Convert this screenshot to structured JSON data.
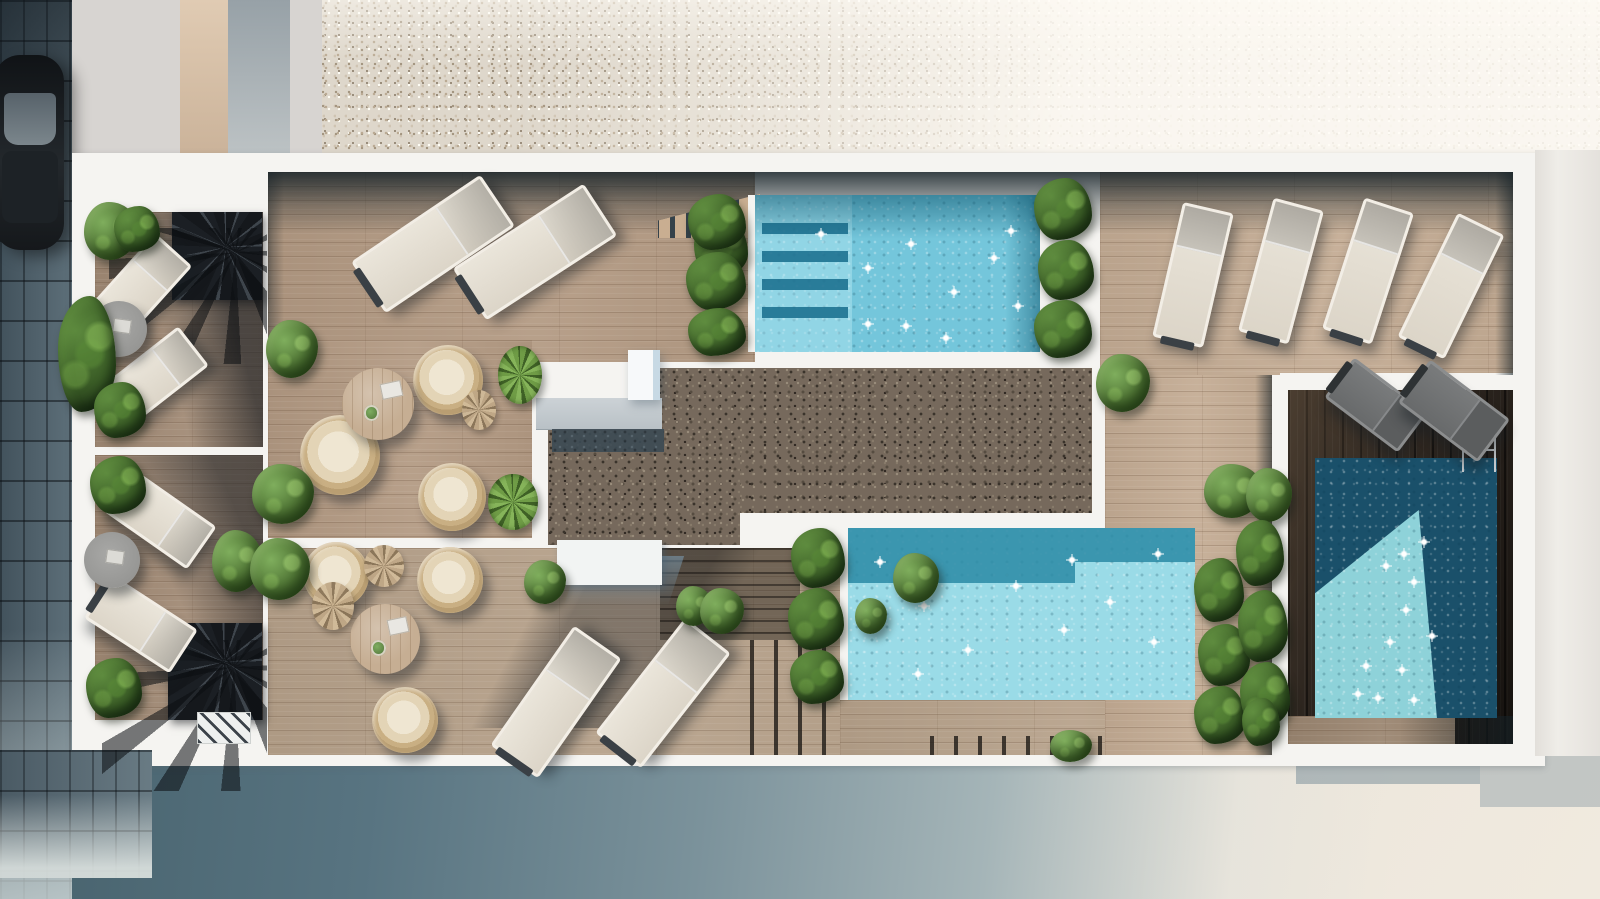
{
  "colors": {
    "white_paint": "#f5f4f1",
    "facade": "#ecebe6",
    "plaza_light": "#e9e2d7",
    "plaza_shadow": "#4a6675",
    "pavement": "#4d5c66",
    "car_body": "#17191c",
    "wood_a": "#b39a83",
    "wood_b": "#b7a28b",
    "wood_c": "#c4ac94",
    "wood_balcony": "#a18a75",
    "wood_tan": "#9b8671",
    "gravel_beige": "#ded7cb",
    "gravel_dark": "#76695c",
    "terrace_dark": "#2b241e",
    "water_pool1": "#74c6db",
    "water_pool2": "#9adbe7",
    "water_pool3_deep": "#1a506a",
    "water_pool3_lit": "#8ed2d9",
    "water_shadow_band": "#2a89a4",
    "concrete_slab": "#c6ccd1",
    "table_wood": "#c6ae93",
    "sparkle": "#ffffff"
  },
  "scene": {
    "loungers": [
      {
        "n": "sun-lounger",
        "v": "cream",
        "x": 355,
        "y": 213,
        "w": 150,
        "h": 56,
        "r": -34
      },
      {
        "n": "sun-lounger",
        "v": "cream",
        "x": 457,
        "y": 221,
        "w": 150,
        "h": 56,
        "r": -33
      },
      {
        "n": "sun-lounger",
        "v": "p",
        "x": 1167,
        "y": 206,
        "w": 46,
        "h": 132,
        "r": 13
      },
      {
        "n": "sun-lounger",
        "v": "p",
        "x": 1255,
        "y": 202,
        "w": 46,
        "h": 132,
        "r": 15
      },
      {
        "n": "sun-lounger",
        "v": "p",
        "x": 1342,
        "y": 202,
        "w": 46,
        "h": 132,
        "r": 18
      },
      {
        "n": "sun-lounger",
        "v": "p",
        "x": 1425,
        "y": 217,
        "w": 46,
        "h": 132,
        "r": 26
      },
      {
        "n": "sun-lounger",
        "v": "cream",
        "x": 483,
        "y": 673,
        "w": 140,
        "h": 52,
        "r": -55
      },
      {
        "n": "sun-lounger",
        "v": "cream",
        "x": 590,
        "y": 664,
        "w": 140,
        "h": 52,
        "r": -52
      },
      {
        "n": "sun-lounger",
        "v": "cream",
        "x": 92,
        "y": 261,
        "w": 92,
        "h": 44,
        "r": -48
      },
      {
        "n": "sun-lounger",
        "v": "cream",
        "x": 106,
        "y": 351,
        "w": 92,
        "h": 44,
        "r": -38
      },
      {
        "n": "sun-lounger",
        "v": "cream",
        "x": 109,
        "y": 493,
        "w": 96,
        "h": 46,
        "r": 35
      },
      {
        "n": "sun-lounger",
        "v": "cream",
        "x": 90,
        "y": 598,
        "w": 96,
        "h": 46,
        "r": 33
      },
      {
        "n": "sun-lounger",
        "v": "gray",
        "x": 1330,
        "y": 380,
        "w": 86,
        "h": 44,
        "r": 37
      },
      {
        "n": "sun-lounger",
        "v": "gray",
        "x": 1404,
        "y": 384,
        "w": 94,
        "h": 48,
        "r": 37
      }
    ],
    "chairs": [
      {
        "n": "rattan-chair",
        "x": 413,
        "y": 345,
        "w": 70,
        "h": 70
      },
      {
        "n": "rattan-chair",
        "x": 300,
        "y": 415,
        "w": 80,
        "h": 80
      },
      {
        "n": "rattan-chair",
        "x": 418,
        "y": 463,
        "w": 68,
        "h": 68
      },
      {
        "n": "rattan-chair",
        "x": 303,
        "y": 542,
        "w": 66,
        "h": 66
      },
      {
        "n": "rattan-chair",
        "x": 417,
        "y": 547,
        "w": 66,
        "h": 66
      },
      {
        "n": "rattan-chair",
        "x": 372,
        "y": 687,
        "w": 66,
        "h": 66
      }
    ],
    "tables": [
      {
        "n": "round-table",
        "v": "wood",
        "x": 342,
        "y": 368,
        "w": 72,
        "h": 72
      },
      {
        "n": "round-table",
        "v": "wood",
        "x": 350,
        "y": 604,
        "w": 70,
        "h": 70
      },
      {
        "n": "round-table",
        "v": "gray",
        "x": 91,
        "y": 301,
        "w": 56,
        "h": 56
      },
      {
        "n": "round-table",
        "v": "gray",
        "x": 84,
        "y": 532,
        "w": 56,
        "h": 56
      }
    ],
    "plants": [
      {
        "n": "plant",
        "v": "bush",
        "x": 84,
        "y": 202,
        "w": 54,
        "h": 58
      },
      {
        "n": "plant",
        "v": "leafy",
        "x": 58,
        "y": 296,
        "w": 58,
        "h": 116
      },
      {
        "n": "plant",
        "v": "leafy",
        "x": 114,
        "y": 206,
        "w": 46,
        "h": 46
      },
      {
        "n": "plant",
        "v": "leafy",
        "x": 94,
        "y": 382,
        "w": 52,
        "h": 56
      },
      {
        "n": "plant",
        "v": "leafy",
        "x": 90,
        "y": 456,
        "w": 56,
        "h": 58
      },
      {
        "n": "plant",
        "v": "leafy",
        "x": 86,
        "y": 658,
        "w": 56,
        "h": 60
      },
      {
        "n": "plant",
        "v": "bush",
        "x": 212,
        "y": 530,
        "w": 50,
        "h": 62
      },
      {
        "n": "plant",
        "v": "bush",
        "x": 266,
        "y": 320,
        "w": 52,
        "h": 58
      },
      {
        "n": "plant",
        "v": "bush",
        "x": 252,
        "y": 464,
        "w": 62,
        "h": 60
      },
      {
        "n": "plant",
        "v": "bush",
        "x": 250,
        "y": 538,
        "w": 60,
        "h": 62
      },
      {
        "n": "plant",
        "v": "spiky",
        "x": 498,
        "y": 346,
        "w": 44,
        "h": 58
      },
      {
        "n": "plant",
        "v": "spiky",
        "x": 488,
        "y": 474,
        "w": 50,
        "h": 56
      },
      {
        "n": "plant",
        "v": "dry",
        "x": 462,
        "y": 390,
        "w": 34,
        "h": 40
      },
      {
        "n": "plant",
        "v": "dry",
        "x": 364,
        "y": 545,
        "w": 40,
        "h": 42
      },
      {
        "n": "plant",
        "v": "dry",
        "x": 312,
        "y": 582,
        "w": 42,
        "h": 48
      },
      {
        "n": "plant",
        "v": "leafy",
        "x": 694,
        "y": 218,
        "w": 54,
        "h": 60
      },
      {
        "n": "plant",
        "v": "leafy",
        "x": 688,
        "y": 194,
        "w": 58,
        "h": 56
      },
      {
        "n": "plant",
        "v": "leafy",
        "x": 686,
        "y": 252,
        "w": 60,
        "h": 58
      },
      {
        "n": "plant",
        "v": "leafy",
        "x": 688,
        "y": 308,
        "w": 58,
        "h": 48
      },
      {
        "n": "plant",
        "v": "leafy",
        "x": 1034,
        "y": 178,
        "w": 58,
        "h": 62
      },
      {
        "n": "plant",
        "v": "leafy",
        "x": 1038,
        "y": 240,
        "w": 56,
        "h": 60
      },
      {
        "n": "plant",
        "v": "leafy",
        "x": 1034,
        "y": 300,
        "w": 58,
        "h": 58
      },
      {
        "n": "plant",
        "v": "bush",
        "x": 1096,
        "y": 354,
        "w": 54,
        "h": 58
      },
      {
        "n": "plant",
        "v": "bush",
        "x": 1204,
        "y": 464,
        "w": 58,
        "h": 54
      },
      {
        "n": "plant",
        "v": "leafy",
        "x": 791,
        "y": 528,
        "w": 54,
        "h": 60
      },
      {
        "n": "plant",
        "v": "leafy",
        "x": 788,
        "y": 588,
        "w": 56,
        "h": 62
      },
      {
        "n": "plant",
        "v": "leafy",
        "x": 790,
        "y": 650,
        "w": 54,
        "h": 54
      },
      {
        "n": "plant",
        "v": "leafy",
        "x": 1194,
        "y": 558,
        "w": 50,
        "h": 64
      },
      {
        "n": "plant",
        "v": "leafy",
        "x": 1198,
        "y": 624,
        "w": 52,
        "h": 62
      },
      {
        "n": "plant",
        "v": "leafy",
        "x": 1194,
        "y": 686,
        "w": 52,
        "h": 58
      },
      {
        "n": "plant",
        "v": "bush",
        "x": 1246,
        "y": 468,
        "w": 46,
        "h": 54
      },
      {
        "n": "plant",
        "v": "leafy",
        "x": 1236,
        "y": 520,
        "w": 48,
        "h": 66
      },
      {
        "n": "plant",
        "v": "leafy",
        "x": 1238,
        "y": 590,
        "w": 50,
        "h": 72
      },
      {
        "n": "plant",
        "v": "leafy",
        "x": 1240,
        "y": 662,
        "w": 50,
        "h": 66
      },
      {
        "n": "plant",
        "v": "bush",
        "x": 524,
        "y": 560,
        "w": 42,
        "h": 44
      },
      {
        "n": "plant",
        "v": "bush",
        "x": 676,
        "y": 586,
        "w": 36,
        "h": 40
      },
      {
        "n": "plant",
        "v": "bush",
        "x": 700,
        "y": 588,
        "w": 44,
        "h": 46
      },
      {
        "n": "plant",
        "v": "bush",
        "x": 893,
        "y": 553,
        "w": 46,
        "h": 50
      },
      {
        "n": "plant",
        "v": "bush",
        "x": 855,
        "y": 598,
        "w": 32,
        "h": 36
      },
      {
        "n": "plant",
        "v": "bush",
        "x": 1050,
        "y": 730,
        "w": 42,
        "h": 32
      },
      {
        "n": "plant",
        "v": "leafy",
        "x": 1242,
        "y": 698,
        "w": 38,
        "h": 48
      }
    ],
    "sparkles": [
      {
        "x": 815,
        "y": 228
      },
      {
        "x": 862,
        "y": 262
      },
      {
        "x": 905,
        "y": 238
      },
      {
        "x": 948,
        "y": 286
      },
      {
        "x": 900,
        "y": 320
      },
      {
        "x": 988,
        "y": 252
      },
      {
        "x": 1012,
        "y": 300
      },
      {
        "x": 940,
        "y": 332
      },
      {
        "x": 862,
        "y": 318
      },
      {
        "x": 1005,
        "y": 225
      },
      {
        "x": 874,
        "y": 556
      },
      {
        "x": 918,
        "y": 600
      },
      {
        "x": 962,
        "y": 644
      },
      {
        "x": 1010,
        "y": 580
      },
      {
        "x": 1058,
        "y": 624
      },
      {
        "x": 1104,
        "y": 596
      },
      {
        "x": 1148,
        "y": 636
      },
      {
        "x": 1066,
        "y": 554
      },
      {
        "x": 912,
        "y": 668
      },
      {
        "x": 1152,
        "y": 548
      },
      {
        "x": 1398,
        "y": 548
      },
      {
        "x": 1408,
        "y": 576
      },
      {
        "x": 1400,
        "y": 604
      },
      {
        "x": 1384,
        "y": 636
      },
      {
        "x": 1396,
        "y": 664
      },
      {
        "x": 1372,
        "y": 692
      },
      {
        "x": 1418,
        "y": 536
      },
      {
        "x": 1426,
        "y": 630
      },
      {
        "x": 1352,
        "y": 688
      },
      {
        "x": 1408,
        "y": 694
      },
      {
        "x": 1380,
        "y": 560
      },
      {
        "x": 1360,
        "y": 660
      }
    ]
  }
}
